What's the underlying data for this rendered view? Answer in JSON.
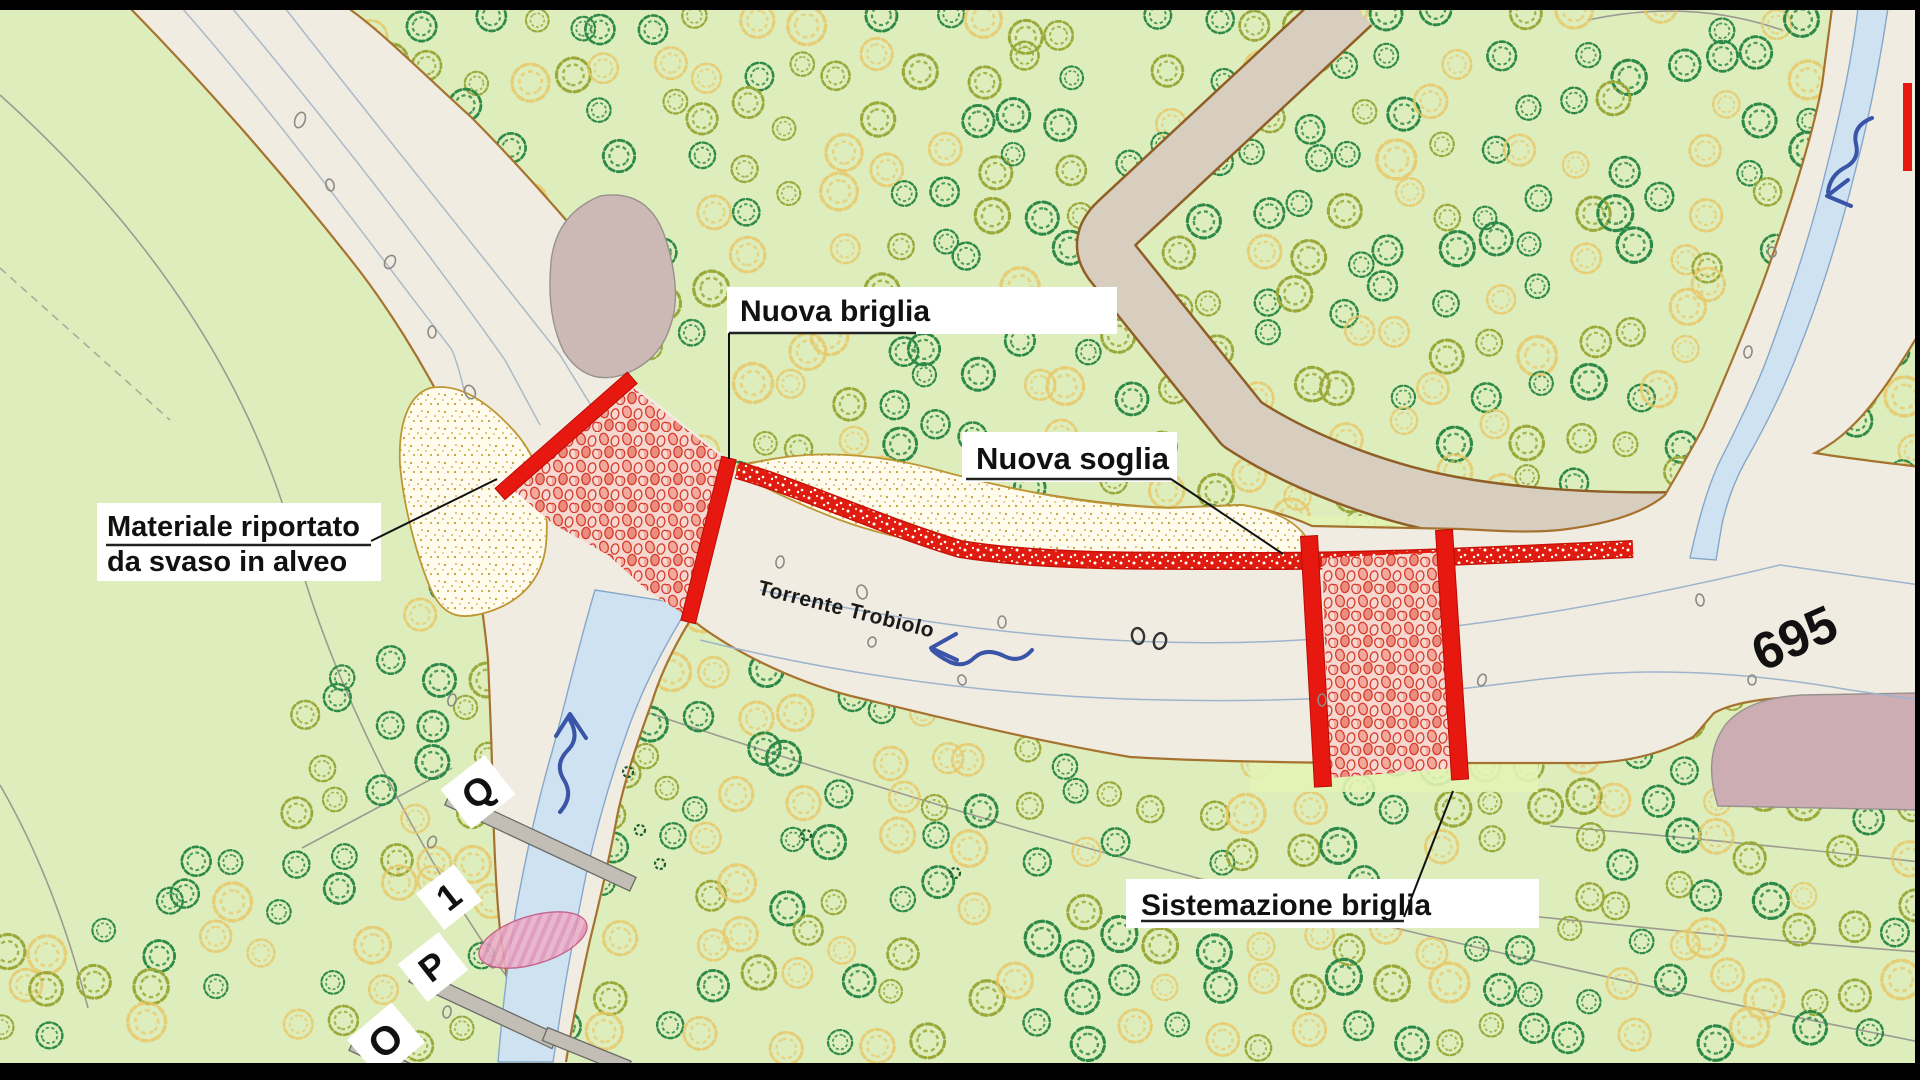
{
  "map": {
    "title": "Piano sistemazione idraulica - Torrente Trobiolo",
    "labels": {
      "nuova_briglia": "Nuova briglia",
      "nuova_soglia": "Nuova soglia",
      "materiale_line1": "Materiale riportato",
      "materiale_line2": "da svaso in alveo",
      "sistemazione_briglia": "Sistemazione briglia",
      "torrente": "Torrente Trobiolo",
      "elevation": "695",
      "section_markers": [
        "Q",
        "1",
        "P",
        "O"
      ]
    },
    "colors": {
      "background_green": "#deedbc",
      "channel_beige": "#f1ece1",
      "bank_brown": "#a5732f",
      "work_red": "#e6180f",
      "sand_fill": "#fffcee",
      "stream_blue": "#cfe2f2",
      "arrow_blue": "#3a54a8",
      "highlight_green": "#e2f3b4",
      "rock_mauve": "#ccb8b4",
      "scree_mauve": "#cbadb3",
      "road_tan": "#d8cec0",
      "tree_dark_green": "#2e8a49",
      "tree_olive": "#9aa93a",
      "tree_pale_yellow": "#e9c767"
    }
  }
}
